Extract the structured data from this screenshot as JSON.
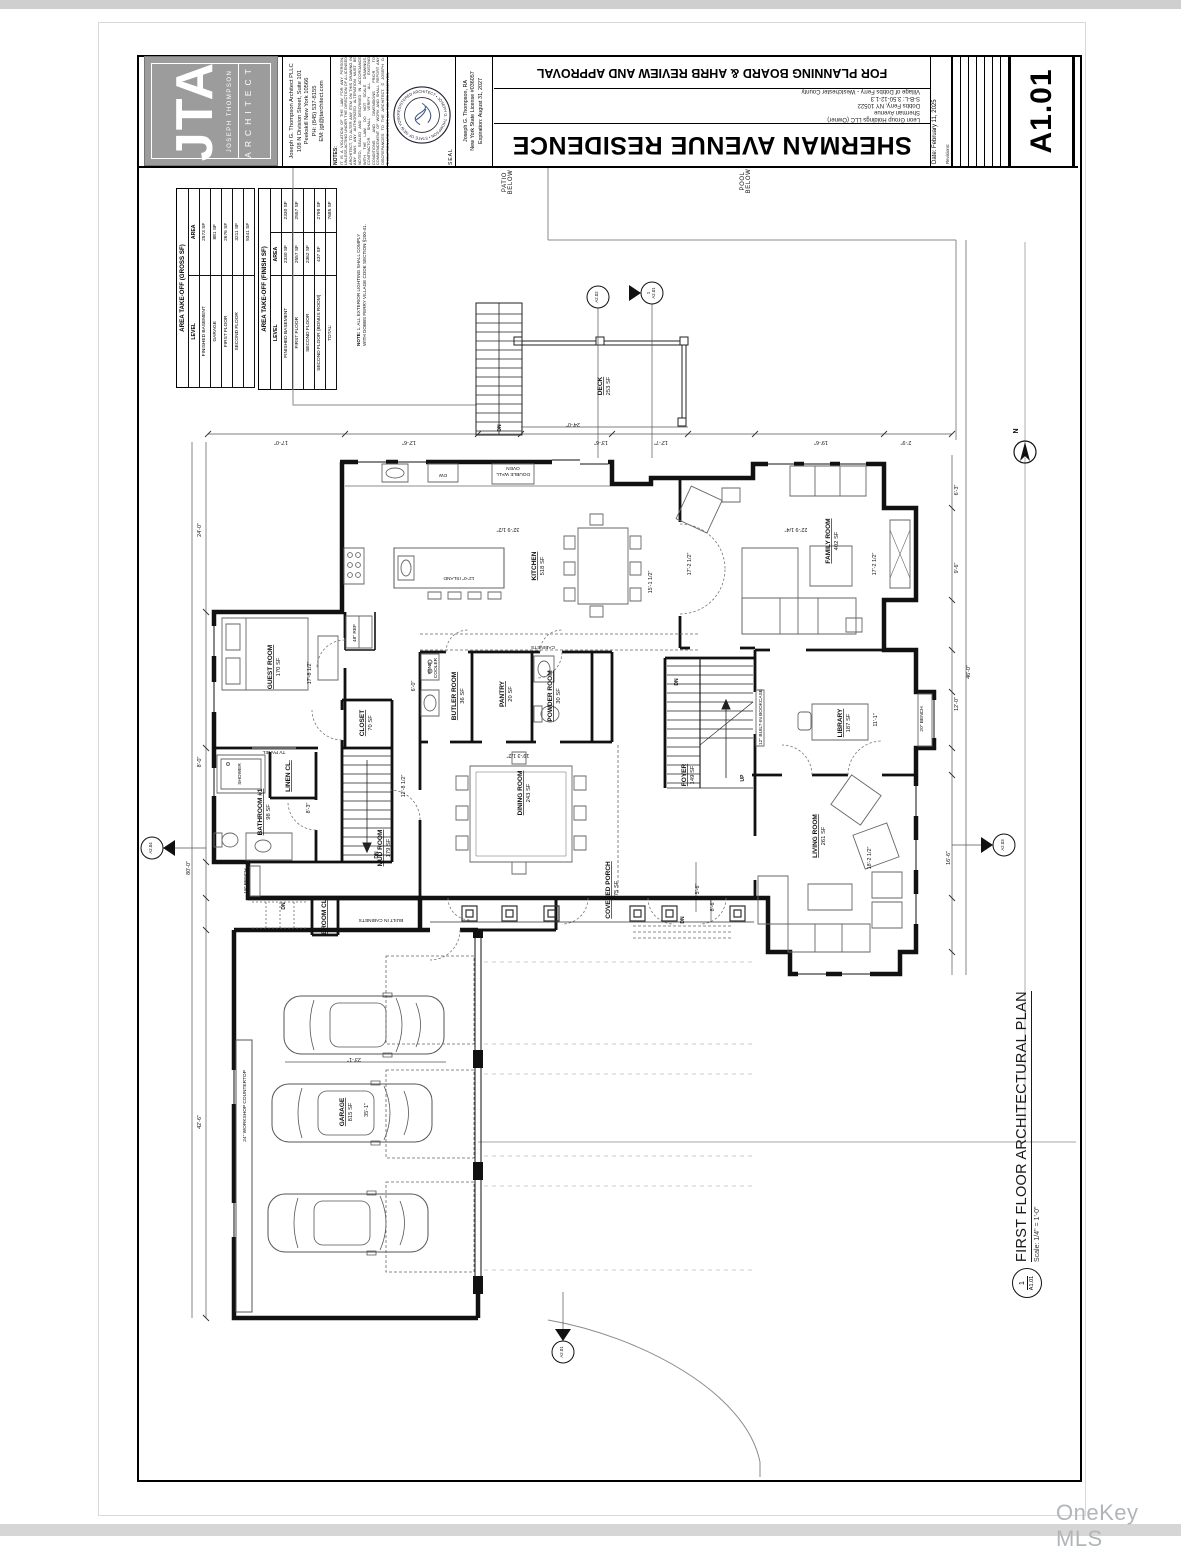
{
  "watermark": "OneKey MLS",
  "title_block": {
    "logo": {
      "initials": "JTA",
      "firm": "JOSEPH THOMPSON",
      "profession": "ARCHITECT"
    },
    "architect_lines": [
      "Joseph G. Thompson Architect PLLC",
      "108 N Division Street, Suite 101",
      "Peekskill New York 10566",
      "PH: (845) 537-8155",
      "EM: jgt@jtarchitect.com"
    ],
    "notes_label": "NOTES:",
    "notes_text": "IT IS A VIOLATION OF THE LAW FOR ANY PERSON, UNLESS ACTING UNDER THE DIRECTION OF A LICENSED ARCHITECT, TO ALTER ANY ITEM ON THIS DRAWING IN ANY WAY. ANY AUTHORIZED ALTERATION MUST BE NOTED, SEALED AND DESCRIBED IN ACCORDANCE WITH THE LAW. DO NOT SCALE DRAWINGS. CONTRACTOR SHALL VERIFY ALL EXISTING CONDITIONS AND DIMENSIONS PRIOR TO COMMENCEMENT OF WORK AND SHALL REPORT ANY DISCREPANCIES TO THE ARCHITECT. © JOSEPH G. THOMPSON ARCHITECT, ALL RIGHTS RESERVED.",
    "seal_label": "SEAL",
    "seal_ring_text": "REGISTERED ARCHITECT • JOSEPH G. THOMPSON • STATE OF NEW YORK •",
    "license_lines": [
      "Joseph G. Thompson, RA",
      "New York State License #036057",
      "Expiration: August 31, 2027"
    ],
    "approval_banner": "FOR PLANNING BOARD & AHRB REVIEW AND APPROVAL",
    "project_lines": [
      "Leon Group Holdings LLC (Owner)",
      "Sherman Avenue",
      "Dobbs Ferry, NY 10522",
      "S-B-L: 3.50-12-1.3",
      "Village of Dobbs Ferry - Westchester County"
    ],
    "sheet_title": "SHERMAN AVENUE RESIDENCE",
    "date_label": "Date: February 11, 2025",
    "revisions_label": "Revisions:",
    "sheet_number": "A1.01"
  },
  "area_tables": [
    {
      "title": "AREA TAKE-OFF (GROSS SF)",
      "headers": [
        "LEVEL",
        "AREA"
      ],
      "rows": [
        [
          "FINISHED BASEMENT",
          "2573 SF"
        ],
        [
          "GARAGE",
          "881 SF"
        ],
        [
          "FIRST FLOOR",
          "2676 SF"
        ],
        [
          "SECOND FLOOR",
          "3211 SF"
        ],
        [
          "",
          "9341 SF"
        ]
      ]
    },
    {
      "title": "AREA TAKE-OFF (FINISH SF)",
      "headers": [
        "LEVEL",
        "AREA",
        ""
      ],
      "rows": [
        [
          "FINISHED BASEMENT",
          "2330 SF",
          "2330 SF"
        ],
        [
          "FIRST FLOOR",
          "2557 SF",
          "2557 SF"
        ],
        [
          "SECOND FLOOR",
          "2362 SF",
          ""
        ],
        [
          "SECOND FLOOR (BONUS ROOM)",
          "437 SF",
          "2799 SF"
        ],
        [
          "TOTAL:",
          "",
          "7685 SF"
        ]
      ]
    }
  ],
  "site_note": {
    "label": "NOTE:",
    "text": "1.  ALL EXTERIOR LIGHTING SHALL COMPLY WITH DOBBS FERRY VILLAGE CODE SECTION §200-41."
  },
  "plan_title": {
    "number": "1",
    "sheet": "A1.01",
    "title": "FIRST FLOOR ARCHITECTURAL PLAN",
    "scale": "Scale:  1/4\" = 1'-0\""
  },
  "plan": {
    "labels": [
      {
        "t": "KITCHEN",
        "s": "518 SF",
        "x": 536,
        "y": 566,
        "r": -90,
        "c": "room"
      },
      {
        "t": "FAMILY ROOM",
        "s": "402 SF",
        "x": 830,
        "y": 541,
        "r": -90,
        "c": "room"
      },
      {
        "t": "GUEST ROOM",
        "s": "170 SF",
        "x": 272,
        "y": 667,
        "r": -90,
        "c": "room"
      },
      {
        "t": "BUTLER ROOM",
        "s": "36 SF",
        "x": 456,
        "y": 696,
        "r": -90,
        "c": "room"
      },
      {
        "t": "PANTRY",
        "s": "20 SF",
        "x": 504,
        "y": 694,
        "r": -90,
        "c": "room"
      },
      {
        "t": "POWDER ROOM",
        "s": "30 SF",
        "x": 552,
        "y": 696,
        "r": -90,
        "c": "room"
      },
      {
        "t": "CLOSET",
        "s": "70 SF",
        "x": 364,
        "y": 723,
        "r": -90,
        "c": "room"
      },
      {
        "t": "LINEN CL.",
        "x": 290,
        "y": 776,
        "r": -90,
        "c": "room"
      },
      {
        "t": "BATHROOM #1",
        "s": "98 SF",
        "x": 262,
        "y": 812,
        "r": -90,
        "c": "room"
      },
      {
        "t": "MUD ROOM",
        "s": "179 SF",
        "x": 382,
        "y": 848,
        "r": -90,
        "c": "room"
      },
      {
        "t": "DINING ROOM",
        "s": "243 SF",
        "x": 522,
        "y": 793,
        "r": -90,
        "c": "room"
      },
      {
        "t": "FOYER",
        "s": "149 SF",
        "x": 686,
        "y": 775,
        "r": -90,
        "c": "room"
      },
      {
        "t": "LIBRARY",
        "s": "187 SF",
        "x": 842,
        "y": 723,
        "r": -90,
        "c": "room"
      },
      {
        "t": "LIVING ROOM",
        "s": "261 SF",
        "x": 817,
        "y": 836,
        "r": -90,
        "c": "room"
      },
      {
        "t": "COVERED PORCH",
        "s": "175 SF",
        "x": 610,
        "y": 890,
        "r": -90,
        "c": "room"
      },
      {
        "t": "GARAGE",
        "s": "815 SF",
        "x": 344,
        "y": 1112,
        "r": -90,
        "c": "room"
      },
      {
        "t": "DECK",
        "s": "253 SF",
        "x": 602,
        "y": 386,
        "r": -90,
        "c": "room"
      },
      {
        "t": "BROOM CL.",
        "x": 326,
        "y": 916,
        "r": -90,
        "c": "room"
      },
      {
        "t": "PATIO",
        "s": "BELOW",
        "x": 506,
        "y": 182,
        "r": -90,
        "c": "place"
      },
      {
        "t": "POOL",
        "s": "BELOW",
        "x": 744,
        "y": 181,
        "r": -90,
        "c": "place"
      },
      {
        "t": "48\" REF",
        "x": 356,
        "y": 633,
        "r": -90,
        "c": "small"
      },
      {
        "t": "WINE",
        "s": "COOLER",
        "x": 431,
        "y": 668,
        "r": -90,
        "c": "small"
      },
      {
        "t": "SHOWER",
        "x": 241,
        "y": 774,
        "r": -90,
        "c": "small"
      },
      {
        "t": "18\" BENCH",
        "x": 247,
        "y": 881,
        "r": -90,
        "c": "small"
      },
      {
        "t": "20\" BENCH",
        "x": 923,
        "y": 719,
        "r": -90,
        "c": "small"
      },
      {
        "t": "12\" BUILT-IN BOOKCASE",
        "x": 762,
        "y": 717,
        "r": -90,
        "c": "small"
      },
      {
        "t": "24\" WORKSHOP COUNTERTOP",
        "x": 246,
        "y": 1106,
        "r": -90,
        "c": "small"
      },
      {
        "t": "TV PANEL",
        "x": 274,
        "y": 751,
        "r": 180,
        "c": "small"
      },
      {
        "t": "CABINETS",
        "x": 543,
        "y": 646,
        "r": 180,
        "c": "small"
      },
      {
        "t": "BUILT IN CABINETS",
        "x": 381,
        "y": 919,
        "r": 180,
        "c": "small"
      },
      {
        "t": "DW",
        "x": 443,
        "y": 474,
        "r": 180,
        "c": "small"
      },
      {
        "t": "DOUBLE WALL",
        "s": "OVEN",
        "x": 513,
        "y": 473,
        "r": 180,
        "c": "small"
      },
      {
        "t": "12'-0\" ISLAND",
        "x": 459,
        "y": 577,
        "r": 180,
        "c": "small"
      },
      {
        "t": "DN",
        "x": 501,
        "y": 428,
        "r": -90,
        "c": "flow"
      },
      {
        "t": "DN",
        "x": 285,
        "y": 906,
        "r": -90,
        "c": "flow"
      },
      {
        "t": "DN",
        "x": 678,
        "y": 682,
        "r": -90,
        "c": "flow"
      },
      {
        "t": "DN",
        "x": 684,
        "y": 920,
        "r": -90,
        "c": "flow"
      },
      {
        "t": "DN",
        "x": 378,
        "y": 855,
        "r": -90,
        "c": "flow"
      },
      {
        "t": "UP",
        "x": 744,
        "y": 778,
        "r": -90,
        "c": "flow"
      },
      {
        "t": "17'-0\"",
        "x": 281,
        "y": 441,
        "r": 180,
        "c": "dim"
      },
      {
        "t": "12'-6\"",
        "x": 409,
        "y": 441,
        "r": 180,
        "c": "dim"
      },
      {
        "t": "24'-0\"",
        "x": 573,
        "y": 423,
        "r": 180,
        "c": "dim"
      },
      {
        "t": "13'-6\"",
        "x": 601,
        "y": 441,
        "r": 180,
        "c": "dim"
      },
      {
        "t": "12'-7\"",
        "x": 661,
        "y": 441,
        "r": 180,
        "c": "dim"
      },
      {
        "t": "19'-6\"",
        "x": 821,
        "y": 441,
        "r": 180,
        "c": "dim"
      },
      {
        "t": "2'-9\"",
        "x": 906,
        "y": 441,
        "r": 180,
        "c": "dim"
      },
      {
        "t": "32'-9 1/2\"",
        "x": 508,
        "y": 528,
        "r": 180,
        "c": "dim"
      },
      {
        "t": "22'-9 1/4\"",
        "x": 796,
        "y": 528,
        "r": 180,
        "c": "dim"
      },
      {
        "t": "19'-3 1/2\"",
        "x": 518,
        "y": 754,
        "r": 180,
        "c": "dim"
      },
      {
        "t": "23'-1\"",
        "x": 354,
        "y": 1058,
        "r": 180,
        "c": "dim"
      },
      {
        "t": "17'-8 1/2\"",
        "x": 311,
        "y": 673,
        "r": -90,
        "c": "dim"
      },
      {
        "t": "15'-1 1/2\"",
        "x": 652,
        "y": 582,
        "r": -90,
        "c": "dim"
      },
      {
        "t": "17'-2 1/2\"",
        "x": 691,
        "y": 564,
        "r": -90,
        "c": "dim"
      },
      {
        "t": "17'-2 1/2\"",
        "x": 876,
        "y": 564,
        "r": -90,
        "c": "dim"
      },
      {
        "t": "12'-8 1/2\"",
        "x": 405,
        "y": 786,
        "r": -90,
        "c": "dim"
      },
      {
        "t": "8'-3\"",
        "x": 310,
        "y": 808,
        "r": -90,
        "c": "dim"
      },
      {
        "t": "6'-0\"",
        "x": 415,
        "y": 686,
        "r": -90,
        "c": "dim"
      },
      {
        "t": "11'-1\"",
        "x": 877,
        "y": 720,
        "r": -90,
        "c": "dim"
      },
      {
        "t": "18'-2 1/2\"",
        "x": 871,
        "y": 858,
        "r": -90,
        "c": "dim"
      },
      {
        "t": "16'-6\"",
        "x": 950,
        "y": 858,
        "r": -90,
        "c": "dim"
      },
      {
        "t": "6'-3\"",
        "x": 958,
        "y": 490,
        "r": -90,
        "c": "dim"
      },
      {
        "t": "9'-6\"",
        "x": 958,
        "y": 568,
        "r": -90,
        "c": "dim"
      },
      {
        "t": "12'-0\"",
        "x": 958,
        "y": 704,
        "r": -90,
        "c": "dim"
      },
      {
        "t": "46'-0\"",
        "x": 970,
        "y": 672,
        "r": -90,
        "c": "dim"
      },
      {
        "t": "5'-6\"",
        "x": 699,
        "y": 889,
        "r": -90,
        "c": "dim"
      },
      {
        "t": "8'-6\"",
        "x": 714,
        "y": 906,
        "r": -90,
        "c": "dim"
      },
      {
        "t": "35'-1\"",
        "x": 368,
        "y": 1110,
        "r": -90,
        "c": "dim"
      },
      {
        "t": "42'-6\"",
        "x": 201,
        "y": 1122,
        "r": -90,
        "c": "dim"
      },
      {
        "t": "80'-0\"",
        "x": 190,
        "y": 868,
        "r": -90,
        "c": "dim"
      },
      {
        "t": "24'-0\"",
        "x": 201,
        "y": 530,
        "r": -90,
        "c": "dim"
      },
      {
        "t": "8'-0\"",
        "x": 201,
        "y": 762,
        "r": -90,
        "c": "dim"
      },
      {
        "t": "A2.02",
        "x": 598,
        "y": 297,
        "r": -90,
        "c": "marker"
      },
      {
        "t": "1",
        "s": "A2.01",
        "x": 652,
        "y": 293,
        "r": -90,
        "c": "marker"
      },
      {
        "t": "A2.04",
        "x": 152,
        "y": 848,
        "r": -90,
        "c": "marker"
      },
      {
        "t": "A2.03",
        "x": 1004,
        "y": 845,
        "r": -90,
        "c": "marker"
      },
      {
        "t": "A2.01",
        "x": 563,
        "y": 1352,
        "r": -90,
        "c": "marker"
      },
      {
        "t": "N",
        "x": 1018,
        "y": 431,
        "r": -90,
        "c": "north"
      }
    ]
  }
}
